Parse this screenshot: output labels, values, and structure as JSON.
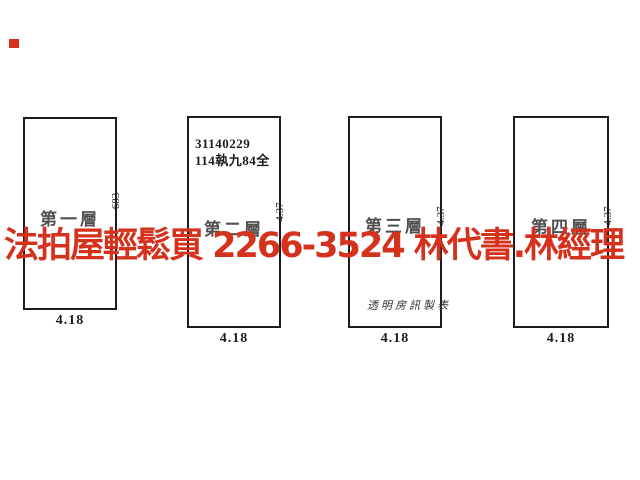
{
  "colors": {
    "background": "#ffffff",
    "line_ink": "#1c1c1c",
    "watermark_red": "#d5321e"
  },
  "watermark": {
    "text": "法拍屋輕鬆買  2266-3524  林代書.林經理",
    "phone": "2266-3524"
  },
  "corner_mark": {
    "color": "#d5321e"
  },
  "floors": [
    {
      "label": "第一層",
      "width_dim": "4.18",
      "depth_dim": "683"
    },
    {
      "label": "第二層",
      "width_dim": "4.18",
      "depth_dim": "4.37",
      "annotation_line1": "31140229",
      "annotation_line2": "114執九84全"
    },
    {
      "label": "第三層",
      "width_dim": "4.18",
      "depth_dim": "4.37",
      "producer_credit": "透明房訊製表"
    },
    {
      "label": "第四層",
      "width_dim": "4.18",
      "depth_dim": "4.37"
    }
  ]
}
